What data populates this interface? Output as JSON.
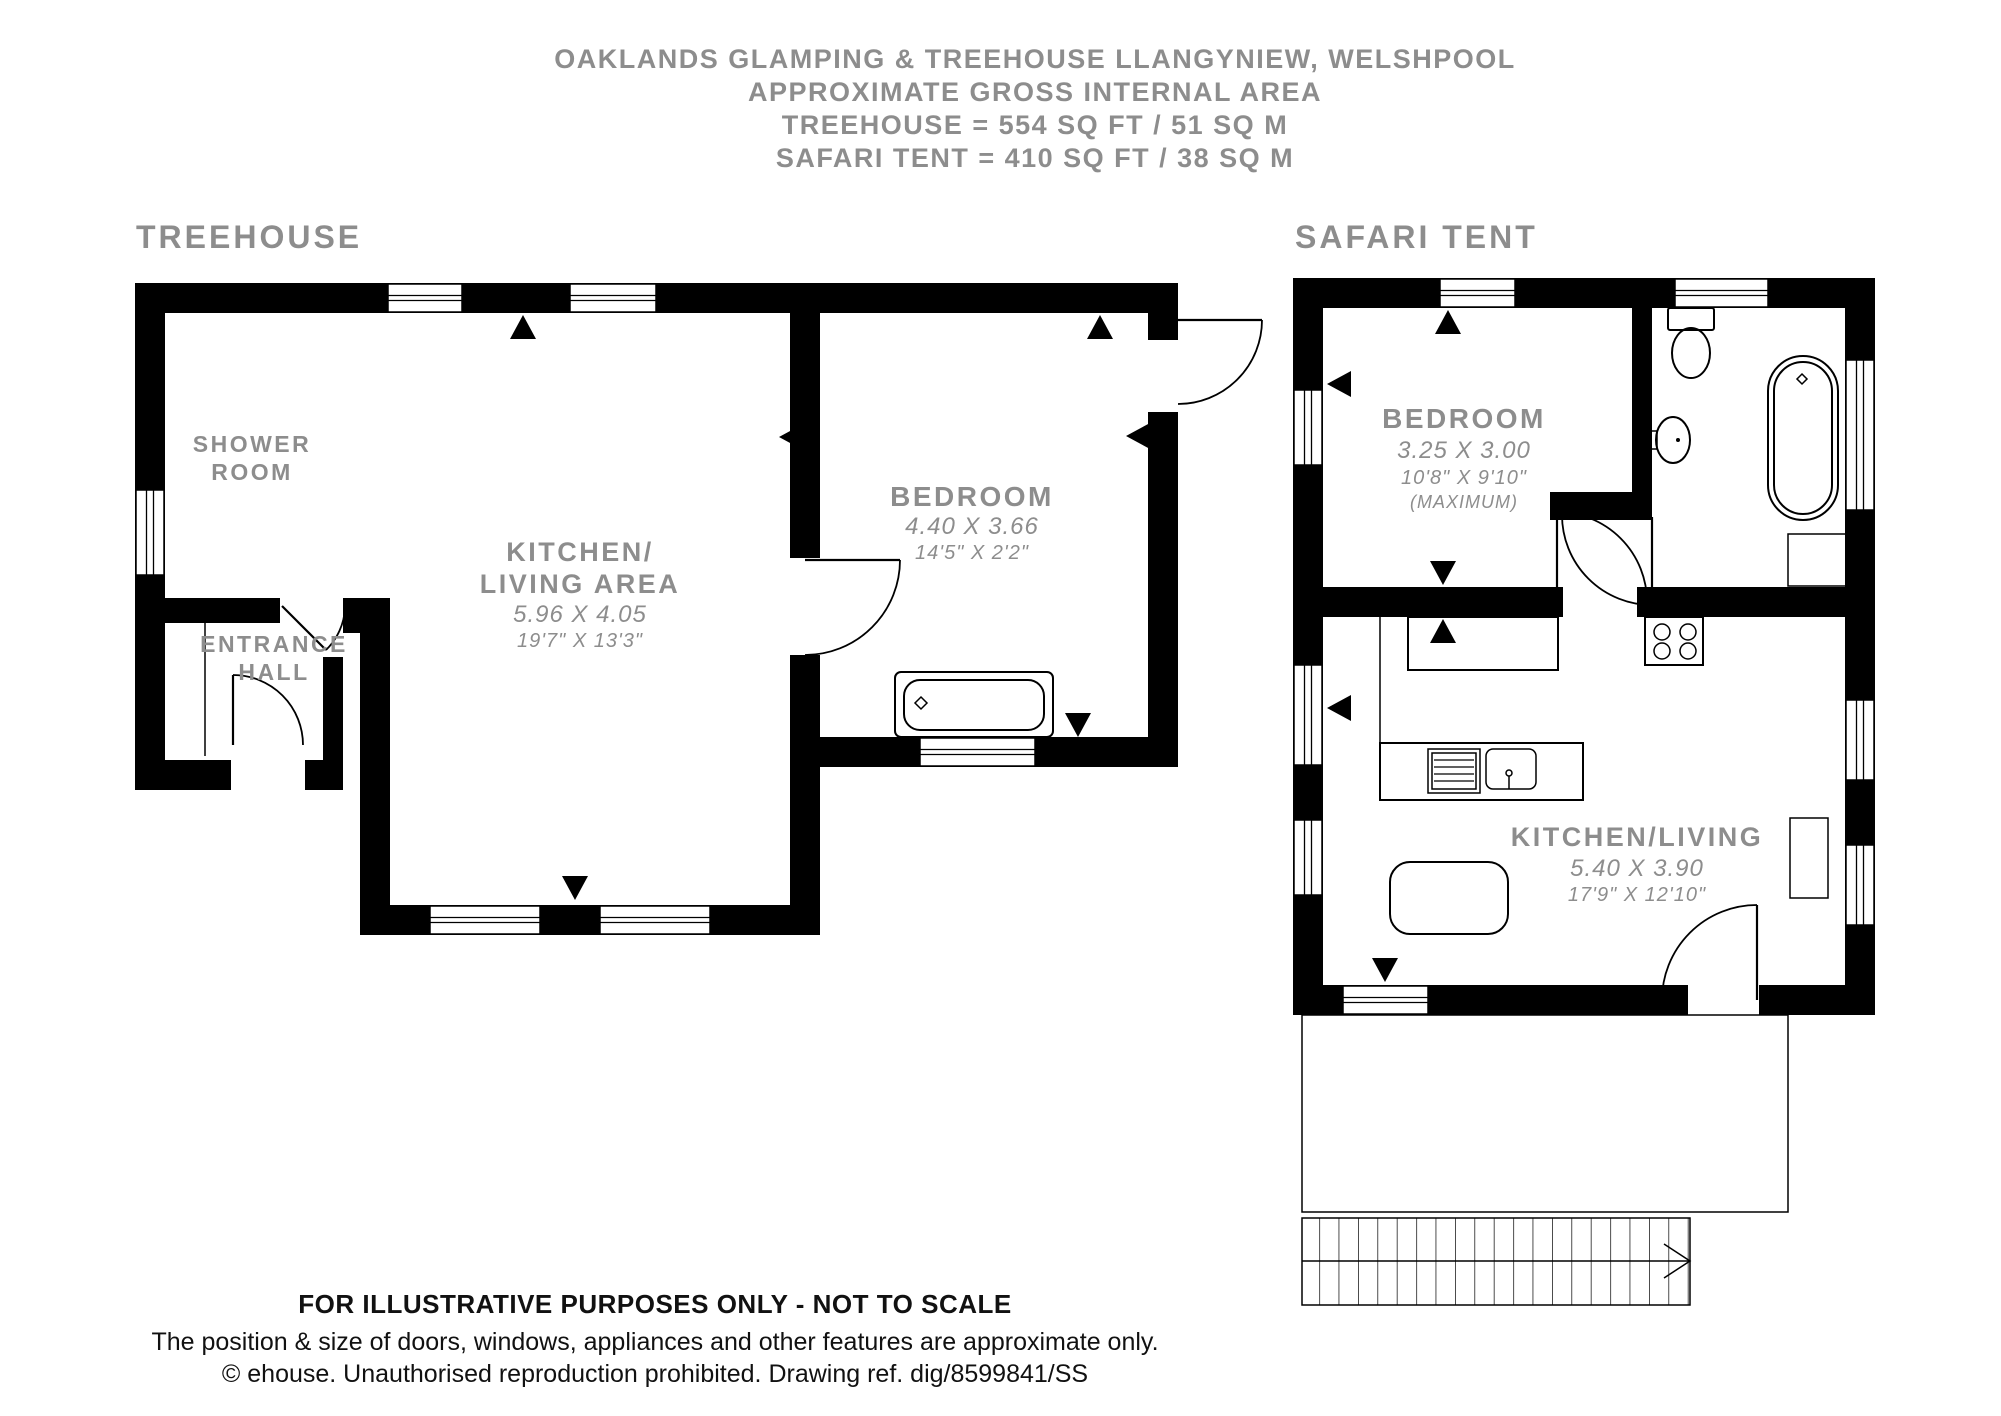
{
  "title": {
    "line1": "OAKLANDS GLAMPING & TREEHOUSE LLANGYNIEW, WELSHPOOL",
    "line2": "APPROXIMATE GROSS INTERNAL AREA",
    "line3": "TREEHOUSE = 554 SQ FT / 51 SQ M",
    "line4": "SAFARI TENT = 410 SQ FT / 38 SQ M"
  },
  "plans": {
    "treehouse": {
      "label": "TREEHOUSE",
      "rooms": {
        "shower": {
          "line1": "SHOWER",
          "line2": "ROOM"
        },
        "hall": {
          "line1": "ENTRANCE",
          "line2": "HALL"
        },
        "kitchen": {
          "line1": "KITCHEN/",
          "line2": "LIVING AREA",
          "metric": "5.96 X 4.05",
          "imperial": "19'7\" X 13'3\""
        },
        "bedroom": {
          "line1": "BEDROOM",
          "metric": "4.40 X 3.66",
          "imperial": "14'5\" X 2'2\""
        }
      }
    },
    "safari": {
      "label": "SAFARI TENT",
      "rooms": {
        "bedroom": {
          "line1": "BEDROOM",
          "metric": "3.25 X 3.00",
          "imperial": "10'8\" X 9'10\"",
          "note": "(MAXIMUM)"
        },
        "kitchen": {
          "line1": "KITCHEN/LIVING",
          "metric": "5.40 X 3.90",
          "imperial": "17'9\" X 12'10\""
        }
      }
    }
  },
  "footer": {
    "line1": "FOR ILLUSTRATIVE PURPOSES ONLY - NOT TO SCALE",
    "line2": "The position & size of doors, windows, appliances and other features are approximate only.",
    "line3": "© ehouse. Unauthorised reproduction prohibited. Drawing ref. dig/8599841/SS"
  },
  "colors": {
    "wall": "#000000",
    "label_gray": "#8d8d8d",
    "footer_text": "#111111"
  }
}
